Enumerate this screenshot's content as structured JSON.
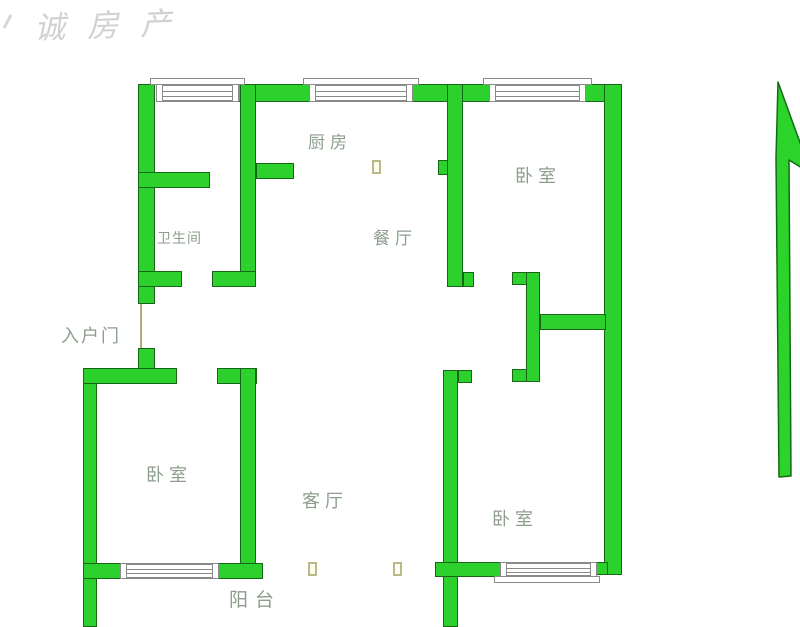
{
  "watermark": "诚房产",
  "rooms": {
    "kitchen": "厨房",
    "bedroom_top_right": "卧室",
    "bathroom": "卫生间",
    "dining": "餐厅",
    "entrance": "入户门",
    "bedroom_bottom_left": "卧室",
    "living": "客厅",
    "bedroom_bottom_right": "卧室",
    "balcony": "阳台"
  },
  "colors": {
    "wall_fill": "#2dd12d",
    "wall_outline": "#166616",
    "window_line": "#8a8a8a",
    "label": "#8d9e8d",
    "door_symbol": "#b9b98a",
    "watermark": "#c6c6c6",
    "arrow_fill": "#2bd32b",
    "arrow_outline": "#156b15"
  }
}
